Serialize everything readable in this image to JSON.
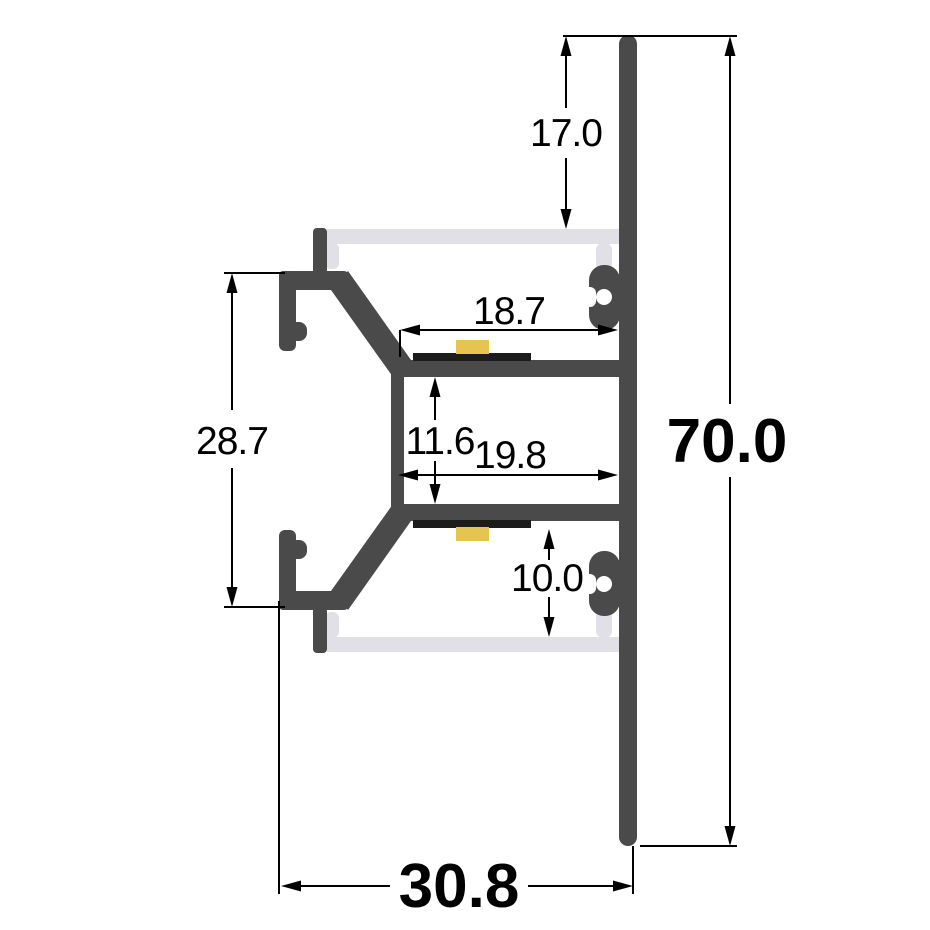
{
  "title": "Aluminium LED profile cross-section drawing",
  "colors": {
    "background": "#ffffff",
    "aluminum": "#4a4a4a",
    "diffuser": "#e0e0e6",
    "led_pcb": "#1c1c1c",
    "led_chip": "#e6c450",
    "dimension_ink": "#000000"
  },
  "dimensions": [
    {
      "id": "top-channel-depth",
      "label": "17.0",
      "value": 17.0,
      "orientation": "vertical",
      "bold": false
    },
    {
      "id": "overall-height",
      "label": "70.0",
      "value": 70.0,
      "orientation": "vertical",
      "bold": true
    },
    {
      "id": "left-flange-span",
      "label": "28.7",
      "value": 28.7,
      "orientation": "vertical",
      "bold": false
    },
    {
      "id": "upper-platform-width",
      "label": "18.7",
      "value": 18.7,
      "orientation": "horizontal",
      "bold": false
    },
    {
      "id": "inner-box-height",
      "label": "11.6",
      "value": 11.6,
      "orientation": "vertical",
      "bold": false
    },
    {
      "id": "inner-box-width",
      "label": "19.8",
      "value": 19.8,
      "orientation": "horizontal",
      "bold": false
    },
    {
      "id": "bottom-channel-depth",
      "label": "10.0",
      "value": 10.0,
      "orientation": "vertical",
      "bold": false
    },
    {
      "id": "overall-depth",
      "label": "30.8",
      "value": 30.8,
      "orientation": "horizontal",
      "bold": true
    }
  ]
}
